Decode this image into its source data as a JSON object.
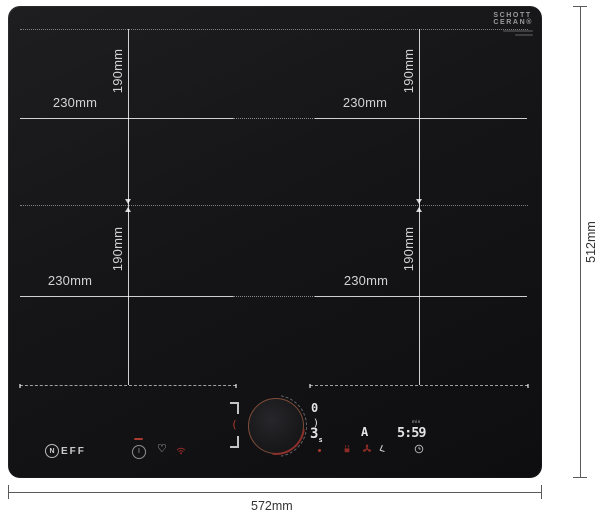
{
  "product": {
    "type": "induction-hob-dimension-diagram",
    "accent_copper": "#7d4c39",
    "accent_red": "#a93a30"
  },
  "hob": {
    "glass_brand": {
      "line1": "SCHOTT",
      "line2": "CERAN®"
    },
    "brand": {
      "initial": "N",
      "rest": "EFF"
    },
    "controls": {
      "power_glyph": "I",
      "heart_glyph": "♡",
      "seg_left_red": "(",
      "seg_right_top": "0",
      "seg_right_mid": ")",
      "seg_level": "3",
      "seg_level_suffix": "s",
      "zone_indicator": "A",
      "timer_value": "5:59",
      "timer_unit": "min"
    }
  },
  "annotations": {
    "overall_width": "572mm",
    "overall_height": "512mm",
    "zone_width": "230mm",
    "zone_height": "190mm"
  }
}
